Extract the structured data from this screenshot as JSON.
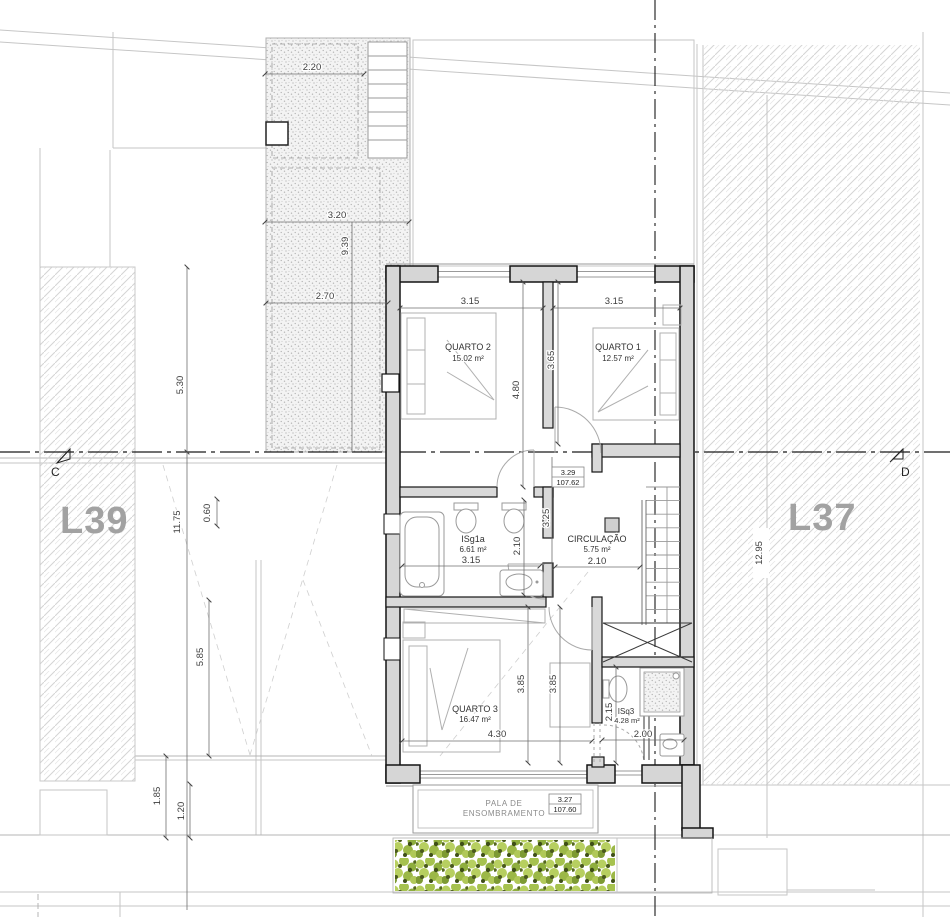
{
  "site": {
    "lot_left": "L39",
    "lot_right": "L37",
    "section_left": "C",
    "section_right": "D"
  },
  "rooms": {
    "q2": {
      "name": "QUARTO 2",
      "area": "15.02 m²",
      "w": "3.15",
      "h": "4.80"
    },
    "q1": {
      "name": "QUARTO 1",
      "area": "12.57 m²",
      "w": "3.15",
      "h": "3.65"
    },
    "isg": {
      "name": "ISg1a",
      "area": "6.61 m²",
      "w": "3.15",
      "h": "2.10"
    },
    "circ": {
      "name": "CIRCULAÇÃO",
      "area": "5.75 m²",
      "w": "2.10",
      "h": "3.25"
    },
    "q3": {
      "name": "QUARTO 3",
      "area": "16.47 m²",
      "w": "4.30",
      "h1": "3.85",
      "h2": "3.85"
    },
    "isq3": {
      "name": "ISq3",
      "area": "4.28 m²",
      "w": "2.00",
      "h": "2.15"
    },
    "pala": {
      "l1": "PALA DE",
      "l2": "ENSOMBRAMENTO"
    }
  },
  "levels": {
    "upper": {
      "rel": "3.29",
      "abs": "107.62"
    },
    "lower": {
      "rel": "3.27",
      "abs": "107.60"
    }
  },
  "dims": {
    "t220": "2.20",
    "t320": "3.20",
    "t939": "9.39",
    "t270": "2.70",
    "d530": "5.30",
    "d1175": "11.75",
    "d060": "0.60",
    "d585": "5.85",
    "d185": "1.85",
    "d120": "1.20",
    "d1295": "12.95"
  }
}
